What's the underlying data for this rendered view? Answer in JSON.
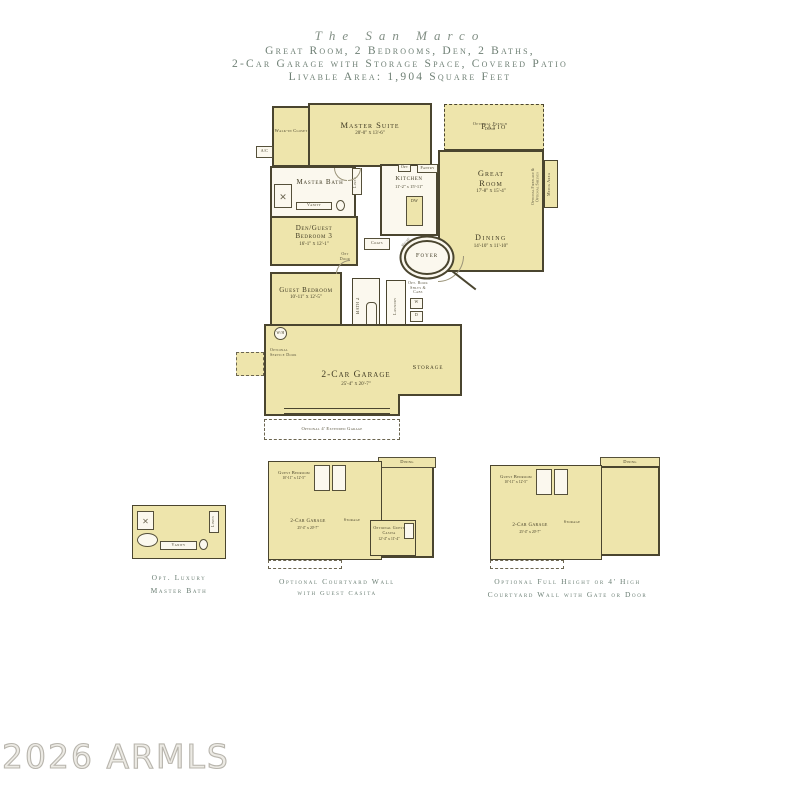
{
  "header": {
    "title": "The San Marco",
    "subtitle1": "Great Room, 2 Bedrooms, Den, 2 Baths,",
    "subtitle2": "2-Car Garage with Storage Space, Covered Patio",
    "subtitle3": "Livable Area: 1,904 Square Feet"
  },
  "colors": {
    "room_fill": "#EEE5AC",
    "wall": "#4A452F",
    "header_text": "#6E7F74",
    "label_text": "#403B24",
    "watermark": "#B8B5AD"
  },
  "plan": {
    "walk_in_closet": "Walk-in Closet",
    "master_suite": {
      "name": "Master Suite",
      "dims": "20'-0\" x 13'-6\""
    },
    "optional_french_door": "Optional French Door",
    "patio": "Patio",
    "ac": "A/C",
    "master_bath": "Master Bath",
    "vanity": "Vanity",
    "linen": "Linen",
    "kitchen": {
      "name": "Kitchen",
      "dims": "11'-2\" x 15'-11\""
    },
    "opt": "Opt",
    "pantry": "Pantry",
    "dw": "DW",
    "great_room": {
      "name": "Great Room",
      "dims": "17'-8\" x 15'-4\""
    },
    "fireplace_note": "Optional Fireplace & Optional Shelves",
    "media_area": "Media Area",
    "dining": {
      "name": "Dining",
      "dims": "14'-10\" x 11'-10\""
    },
    "den": {
      "name": "Den/Guest Bedroom 3",
      "dims": "16'-1\" x 12'-1\""
    },
    "opt_door": "Opt Door",
    "foyer": "Foyer",
    "niche": "Niche",
    "coats": "Coats",
    "guest_bedroom": {
      "name": "Guest Bedroom",
      "dims": "10'-11\" x 12'-5\""
    },
    "bath2": "Bath 2",
    "laundry": "Laundry",
    "opt_book": "Opt. Book Shlvs & Cabs",
    "washer": "W",
    "dryer": "D",
    "water_heater": "W/H",
    "service_door": "Optional Service Door",
    "garage": {
      "name": "2-Car Garage",
      "dims": "25'-4\" x 20'-7\""
    },
    "storage": "Storage",
    "extended_garage": "Optional 4' Extended Garage"
  },
  "options": {
    "luxury_bath": {
      "caption1": "Opt. Luxury",
      "caption2": "Master Bath",
      "vanity": "Vanity",
      "linen": "Linen",
      "shower_glyph": "✕"
    },
    "guest_casita": {
      "caption1": "Optional Courtyard Wall",
      "caption2": "with Guest Casita",
      "dining": "Dining",
      "guest_bedroom": "Guest Bedroom",
      "guest_bedroom_dims": "10'-11\" x 12'-5\"",
      "garage": "2-Car Garage",
      "garage_dims": "25'-4\" x 20'-7\"",
      "storage": "Storage",
      "casita": "Optional Guest Casita",
      "casita_dims": "12'-4\" x 11'-4\""
    },
    "courtyard_wall": {
      "caption1": "Optional Full Height or 4' High",
      "caption2": "Courtyard Wall with Gate or Door",
      "dining": "Dining",
      "guest_bedroom": "Guest Bedroom",
      "guest_bedroom_dims": "10'-11\" x 12'-5\"",
      "garage": "2-Car Garage",
      "garage_dims": "25'-4\" x 20'-7\"",
      "storage": "Storage"
    }
  },
  "watermark": "2026 ARMLS"
}
